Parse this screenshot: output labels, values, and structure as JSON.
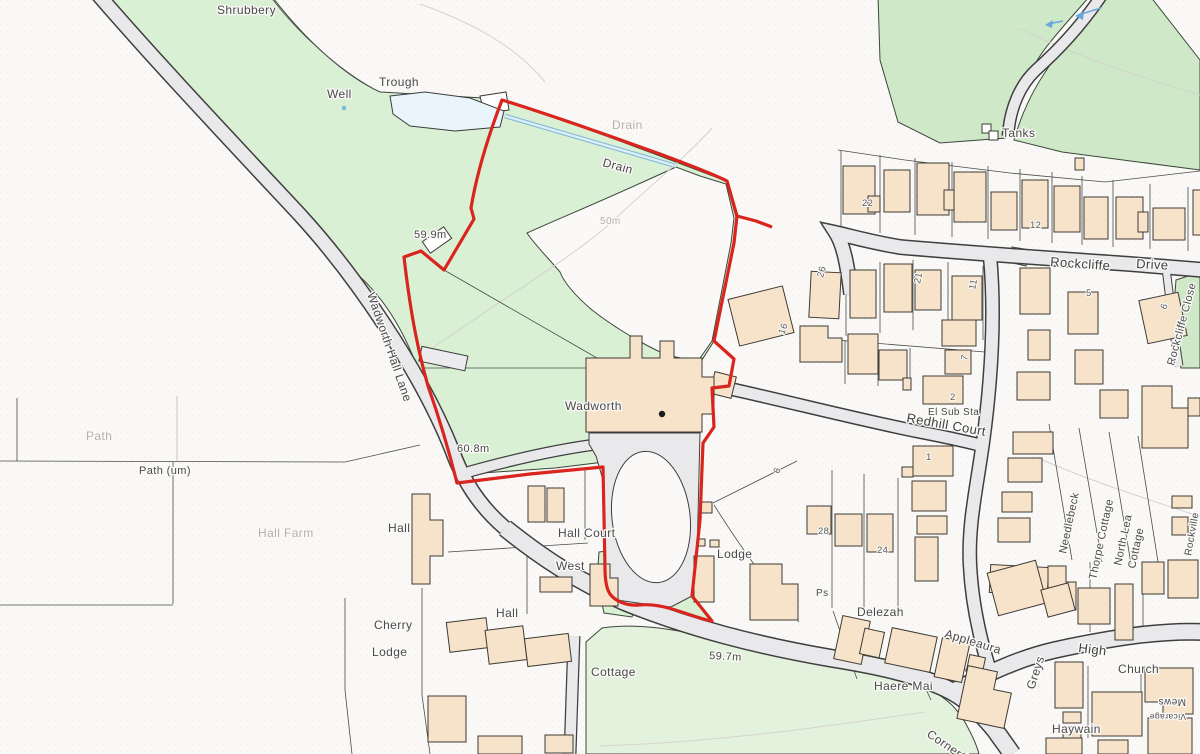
{
  "labels": {
    "shrubbery": "Shrubbery",
    "trough": "Trough",
    "well": "Well",
    "drain_upper": "Drain",
    "drain_lower": "Drain",
    "contour_50m": "50m",
    "spot_59_9": "59.9m",
    "wadworth_hall_lane": "Wadworth Hall Lane",
    "path_faint": "Path",
    "path_um": "Path (um)",
    "hall_farm": "Hall Farm",
    "spot_60_8": "60.8m",
    "wadworth": "Wadworth",
    "hall_west": "Hall",
    "hall_court": "Hall Court",
    "west": "West",
    "hall_south": "Hall",
    "cherry": "Cherry",
    "cherry_lodge": "Lodge",
    "cottage": "Cottage",
    "lodge_east": "Lodge",
    "spot_59_7": "59.7m",
    "tanks": "Tanks",
    "rockcliffe": "Rockcliffe",
    "drive": "Drive",
    "rockcliffe_close": "Rockcliffe Close",
    "el_sub_sta": "El Sub Sta",
    "redhill_court": "Redhill Court",
    "needlebeck": "Needlebeck",
    "thorpe_cottage": "Thorpe Cottage",
    "north_lea_1": "North Lea",
    "north_lea_2": "Cottage",
    "rockville": "Rockville",
    "delezah": "Delezah",
    "appleaura": "Appleaura",
    "haere_mai": "Haere Mai",
    "greys": "Greys",
    "corner_house": "Corner House",
    "high": "High",
    "church": "Church",
    "mews": "Mews",
    "vicarage": "Vicarage",
    "haywain": "Haywain",
    "ps": "Ps"
  },
  "numbers": {
    "n22": "22",
    "n12": "12",
    "n26": "26",
    "n21": "21",
    "n11": "11",
    "n16": "16",
    "n7": "7",
    "n2": "2",
    "n6": "6",
    "n28": "28",
    "n24": "24",
    "n6b": "6",
    "n5": "5",
    "n1": "1"
  },
  "colors": {
    "site-boundary": "#d9251d",
    "building-fill": "#f7e3c9",
    "road-fill": "#e9e9ec",
    "green-light": "#daf0d4",
    "green-dark": "#cfe9c8",
    "water": "#e9f5fb",
    "label-dark": "#4a4a4a",
    "label-faint": "#b3b1ac"
  }
}
